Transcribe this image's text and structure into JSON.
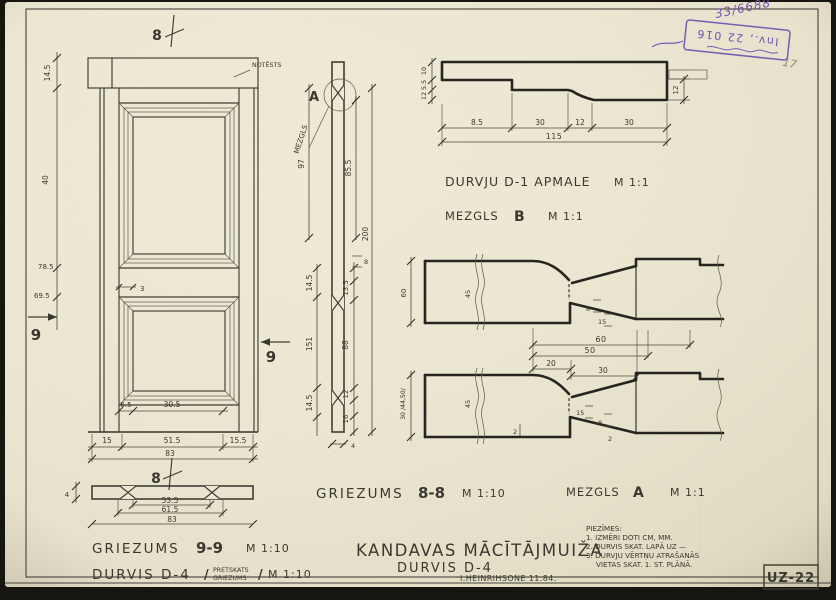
{
  "sheet": {
    "code": "UZ-22",
    "inv_handwritten": "33/6688",
    "stamp_line": "Inv., 22 016",
    "pencil_mark": "17"
  },
  "titles": {
    "project": "KANDAVAS MĀCĪTĀJMUIŽA",
    "object": "DURVIS D-4",
    "author": "I.HEINRIHSONE 11.84.",
    "griezums99": "GRIEZUMS",
    "griezums99_no": "9-9",
    "griezums99_scale": "M 1:10",
    "durvis": "DURVIS D-4",
    "durvis_sub1": "PRETSKATS",
    "durvis_sub2": "GRIEZUMS",
    "durvis_scale": "M 1:10",
    "griezums88": "GRIEZUMS",
    "griezums88_no": "8-8",
    "griezums88_scale": "M 1:10",
    "mezglsA": "MEZGLS",
    "mezglsA_letter": "A",
    "mezglsA_scale": "M 1:1",
    "mezglsB": "MEZGLS",
    "mezglsB_letter": "B",
    "mezglsB_scale": "M 1:1",
    "apmale": "DURVJU D-1 APMALE",
    "apmale_scale": "M 1:1",
    "note_notests": "NOTĒSTS",
    "slash": "/"
  },
  "notes": {
    "heading": "PIEZĪMES:",
    "line1": "1. IZMĒRI DOTI CM, MM.",
    "line2": "2. DURVIS SKAT. LAPĀ UZ —",
    "line3": "3. DURVJU VĒRTŅU ATRAŠANĀS",
    "line4": "VIETAS SKAT. 1. ST. PLĀNĀ."
  },
  "elev": {
    "m8": "8",
    "m9": "9",
    "d_lintel": "14.5",
    "d_upper": "40",
    "d_785": "78.5",
    "d_695": "69.5",
    "d_rail": "3",
    "d_65": "6.5",
    "d_305": "30.5",
    "c15": "15",
    "c515": "51.5",
    "c155": "15.5",
    "total": "83"
  },
  "s99": {
    "d1": "53.5",
    "d2": "61.5",
    "total": "83",
    "thk": "4"
  },
  "s88": {
    "l97": "97",
    "l145a": "14.5",
    "l151": "151",
    "l145b": "14.5",
    "r855": "85.5",
    "r135": "13.5",
    "r88": "88",
    "r12": "12",
    "r16": "16",
    "overall": "200",
    "s8": "8",
    "b4": "4"
  },
  "apm": {
    "c1": "8.5",
    "c2": "30",
    "c3": "12",
    "c4": "30",
    "total": "115",
    "l1": "10",
    "l2": "5.5",
    "l3": "12",
    "r12": "12"
  },
  "mzA": {
    "c60": "60",
    "c50": "50",
    "c20": "20",
    "c30": "30",
    "t8": "8",
    "t15": "15",
    "b15": "15",
    "b8": "8",
    "b2": "2",
    "b2l": "2",
    "v60": "60",
    "v3044": "30 /44,50/",
    "brk": "45"
  }
}
